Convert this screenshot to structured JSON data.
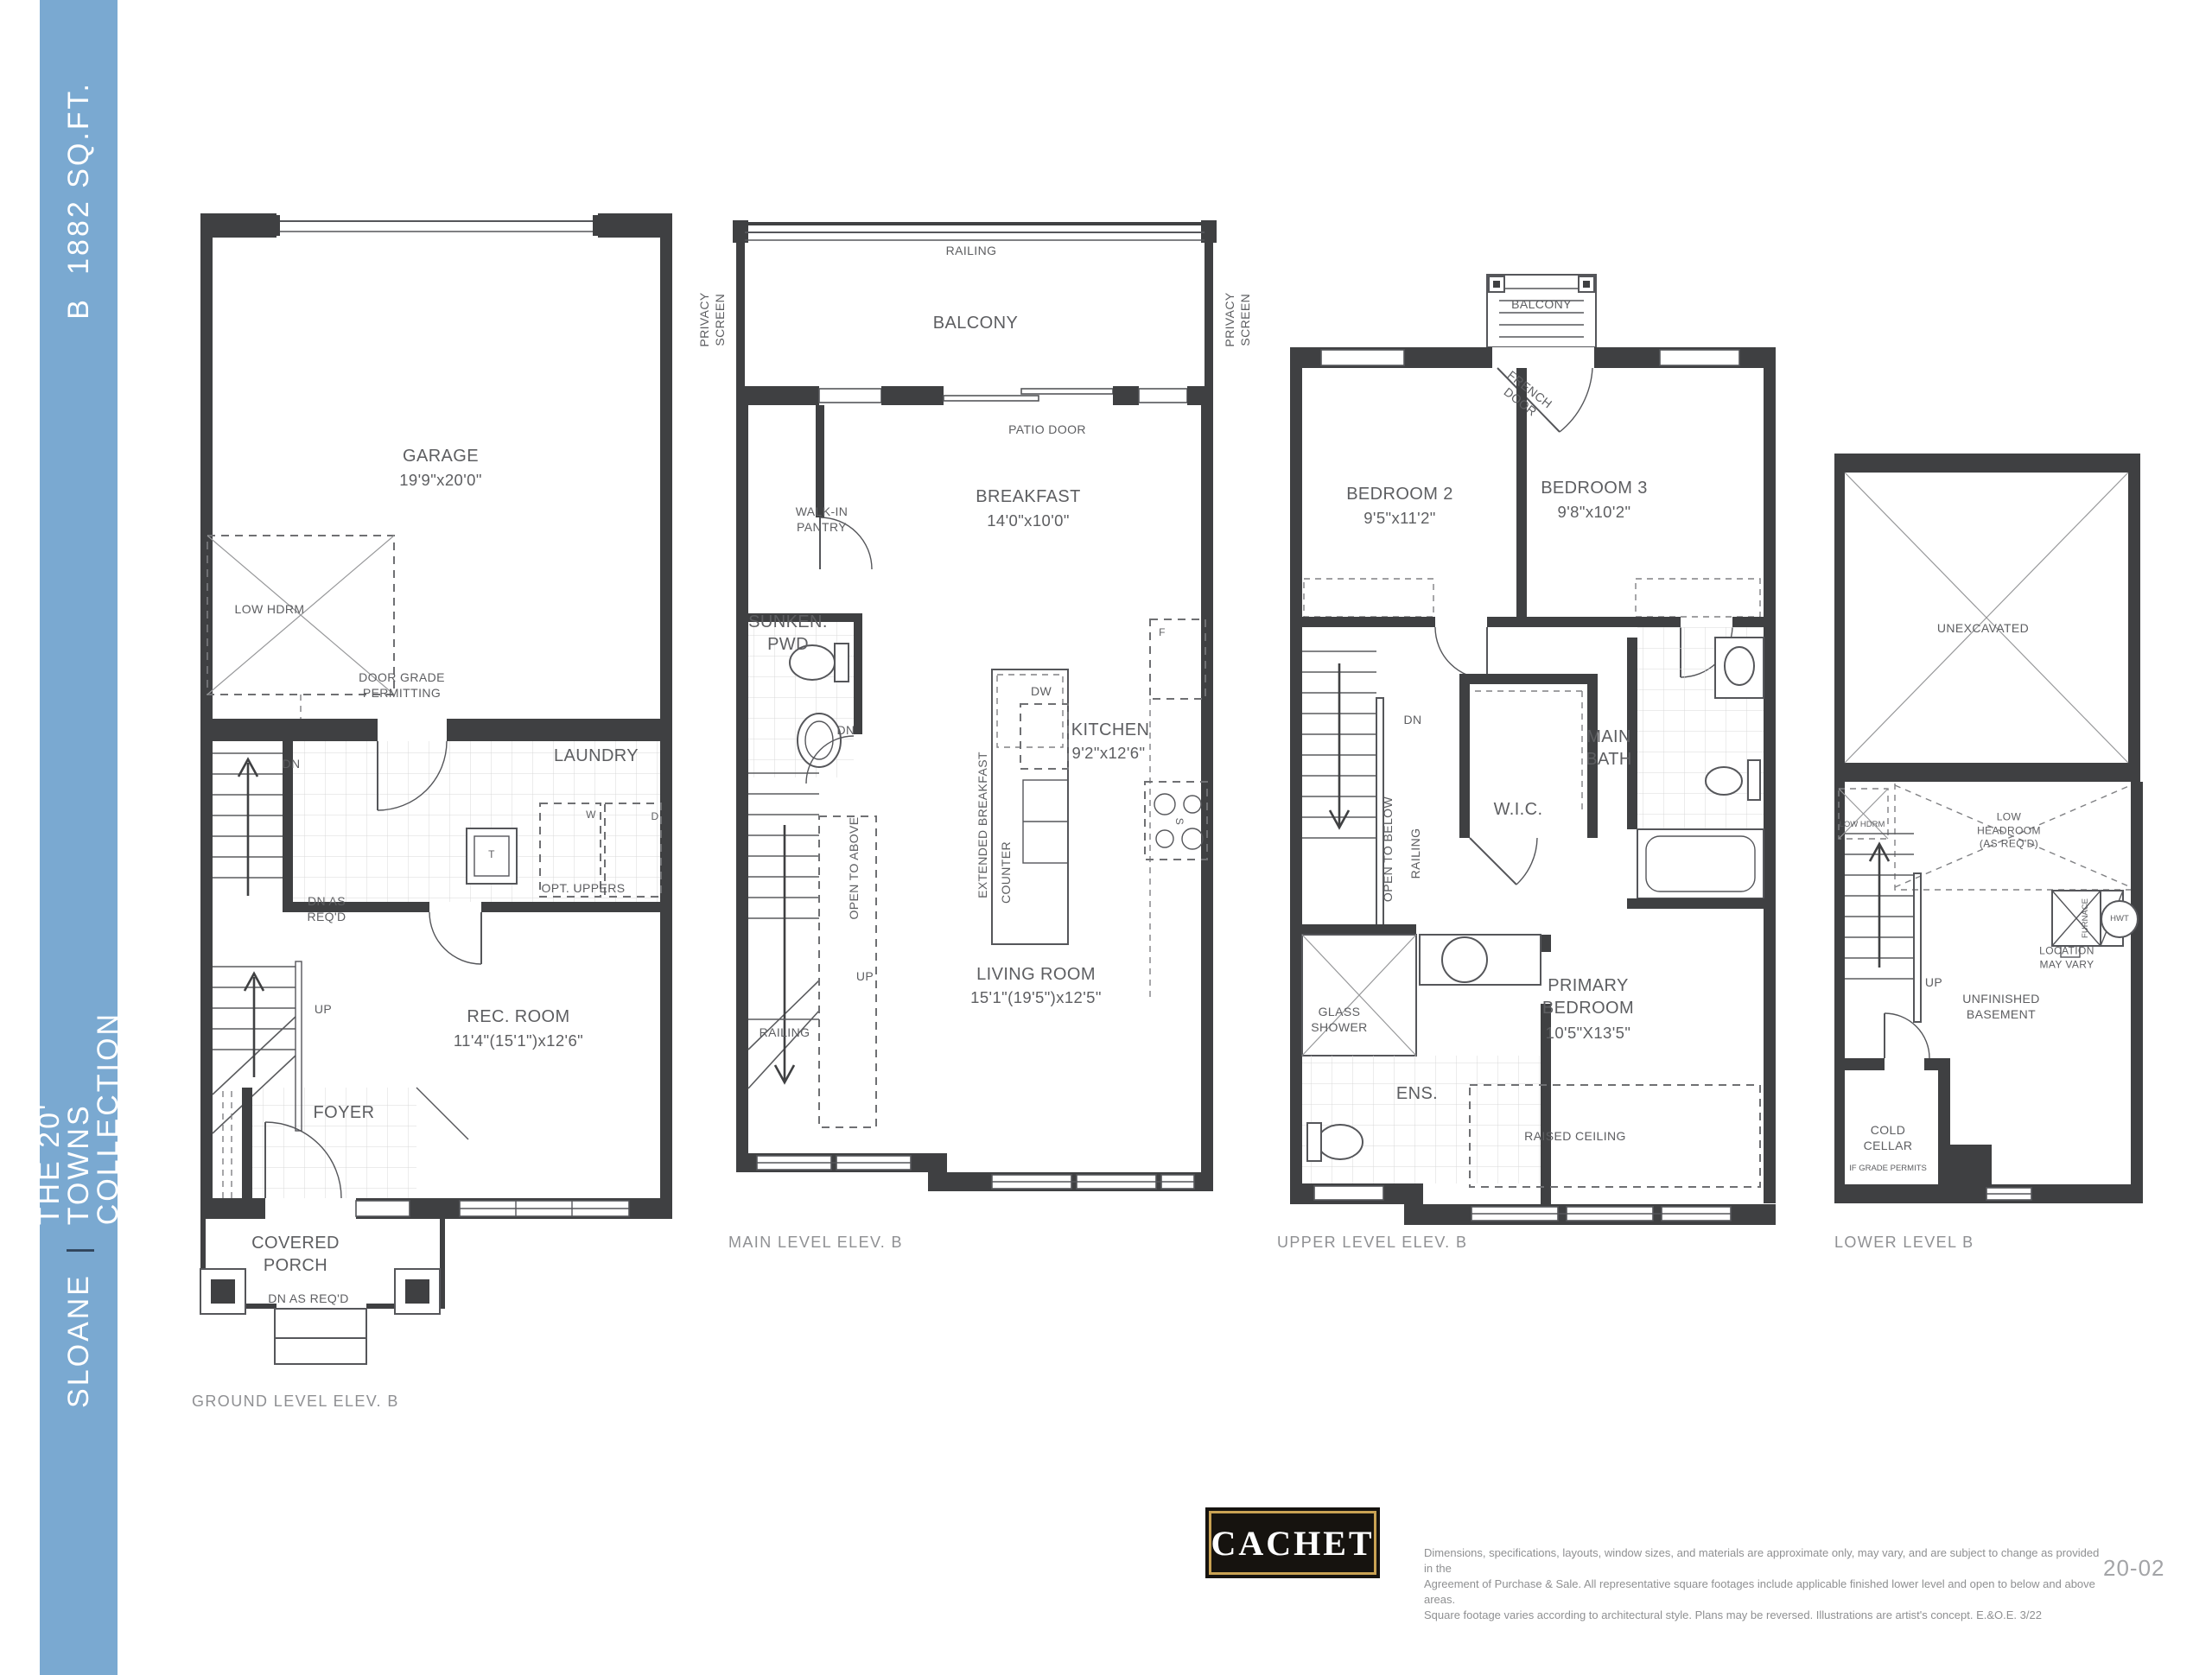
{
  "sidebar": {
    "model": "B",
    "sqft": "1882 SQ.FT.",
    "community": "SLOANE",
    "separator": "|",
    "collection": "THE 20' TOWNS COLLECTION",
    "bg_color": "#7aa9d1"
  },
  "plans": {
    "ground": {
      "caption": "GROUND LEVEL ELEV. B",
      "labels": {
        "garage": "GARAGE",
        "garage_dims": "19'9\"x20'0\"",
        "low_hdrm": "LOW HDRM",
        "door_grade": "DOOR GRADE\nPERMITTING",
        "dn": "DN",
        "laundry": "LAUNDRY",
        "washer": "W",
        "dryer": "D",
        "tank": "T",
        "opt_uppers": "OPT. UPPERS",
        "dn_as_reqd": "DN AS\nREQ'D",
        "up": "UP",
        "rec_room": "REC. ROOM",
        "rec_room_dims": "11'4\"(15'1\")x12'6\"",
        "foyer": "FOYER",
        "covered_porch": "COVERED\nPORCH",
        "porch_dn": "DN AS REQ'D"
      }
    },
    "main": {
      "caption": "MAIN LEVEL ELEV. B",
      "labels": {
        "railing_top": "RAILING",
        "balcony": "BALCONY",
        "privacy_left": "PRIVACY\nSCREEN",
        "privacy_right": "PRIVACY\nSCREEN",
        "patio_door": "PATIO DOOR",
        "walk_in_pantry": "WALK-IN\nPANTRY",
        "breakfast": "BREAKFAST",
        "breakfast_dims": "14'0\"x10'0\"",
        "sunken_pwd": "SUNKEN.\nPWD",
        "dn": "DN",
        "ext_counter_1": "EXTENDED BREAKFAST",
        "ext_counter_2": "COUNTER",
        "dw": "DW",
        "kitchen": "KITCHEN",
        "kitchen_dims": "9'2\"x12'6\"",
        "fridge": "F",
        "stove": "S",
        "open_to_above": "OPEN TO ABOVE",
        "up": "UP",
        "living_room": "LIVING ROOM",
        "living_room_dims": "15'1\"(19'5\")x12'5\"",
        "railing_stairs": "RAILING"
      }
    },
    "upper": {
      "caption": "UPPER LEVEL ELEV. B",
      "labels": {
        "balcony": "BALCONY",
        "french_door": "FRENCH\nDOOR",
        "bedroom2": "BEDROOM 2",
        "bedroom2_dims": "9'5\"x11'2\"",
        "bedroom3": "BEDROOM 3",
        "bedroom3_dims": "9'8\"x10'2\"",
        "dn": "DN",
        "main_bath": "MAIN\nBATH",
        "wic": "W.I.C.",
        "open_to_below": "OPEN TO BELOW",
        "railing": "RAILING",
        "glass_shower": "GLASS\nSHOWER",
        "ens": "ENS.",
        "primary": "PRIMARY\nBEDROOM",
        "primary_dims": "10'5\"X13'5\"",
        "raised_ceiling": "RAISED CEILING"
      }
    },
    "lower": {
      "caption": "LOWER LEVEL B",
      "labels": {
        "unexcavated": "UNEXCAVATED",
        "low_hdrm": "LOW HDRM",
        "low_headroom": "LOW\nHEADROOM\n(AS REQ'D)",
        "furnace": "FURNACE",
        "hwt": "HWT",
        "location": "LOCATION\nMAY VARY",
        "up": "UP",
        "unfinished": "UNFINISHED\nBASEMENT",
        "cold_cellar": "COLD\nCELLAR",
        "if_grade": "IF GRADE PERMITS"
      }
    }
  },
  "footer": {
    "logo_text": "CACHET",
    "disclaimer_lines": [
      "Dimensions, specifications, layouts, window sizes, and materials are approximate only, may vary, and are subject to change as provided in the",
      "Agreement of Purchase & Sale. All representative square footages include applicable finished lower level and open to below and above areas.",
      "Square footage varies according to architectural style. Plans may be reversed. Illustrations are artist's concept. E.&O.E. 3/22"
    ],
    "page_number": "20-02"
  },
  "colors": {
    "accent_blue": "#7aa9d1",
    "logo_gold": "#c9a253",
    "wall": "#3f4042"
  }
}
